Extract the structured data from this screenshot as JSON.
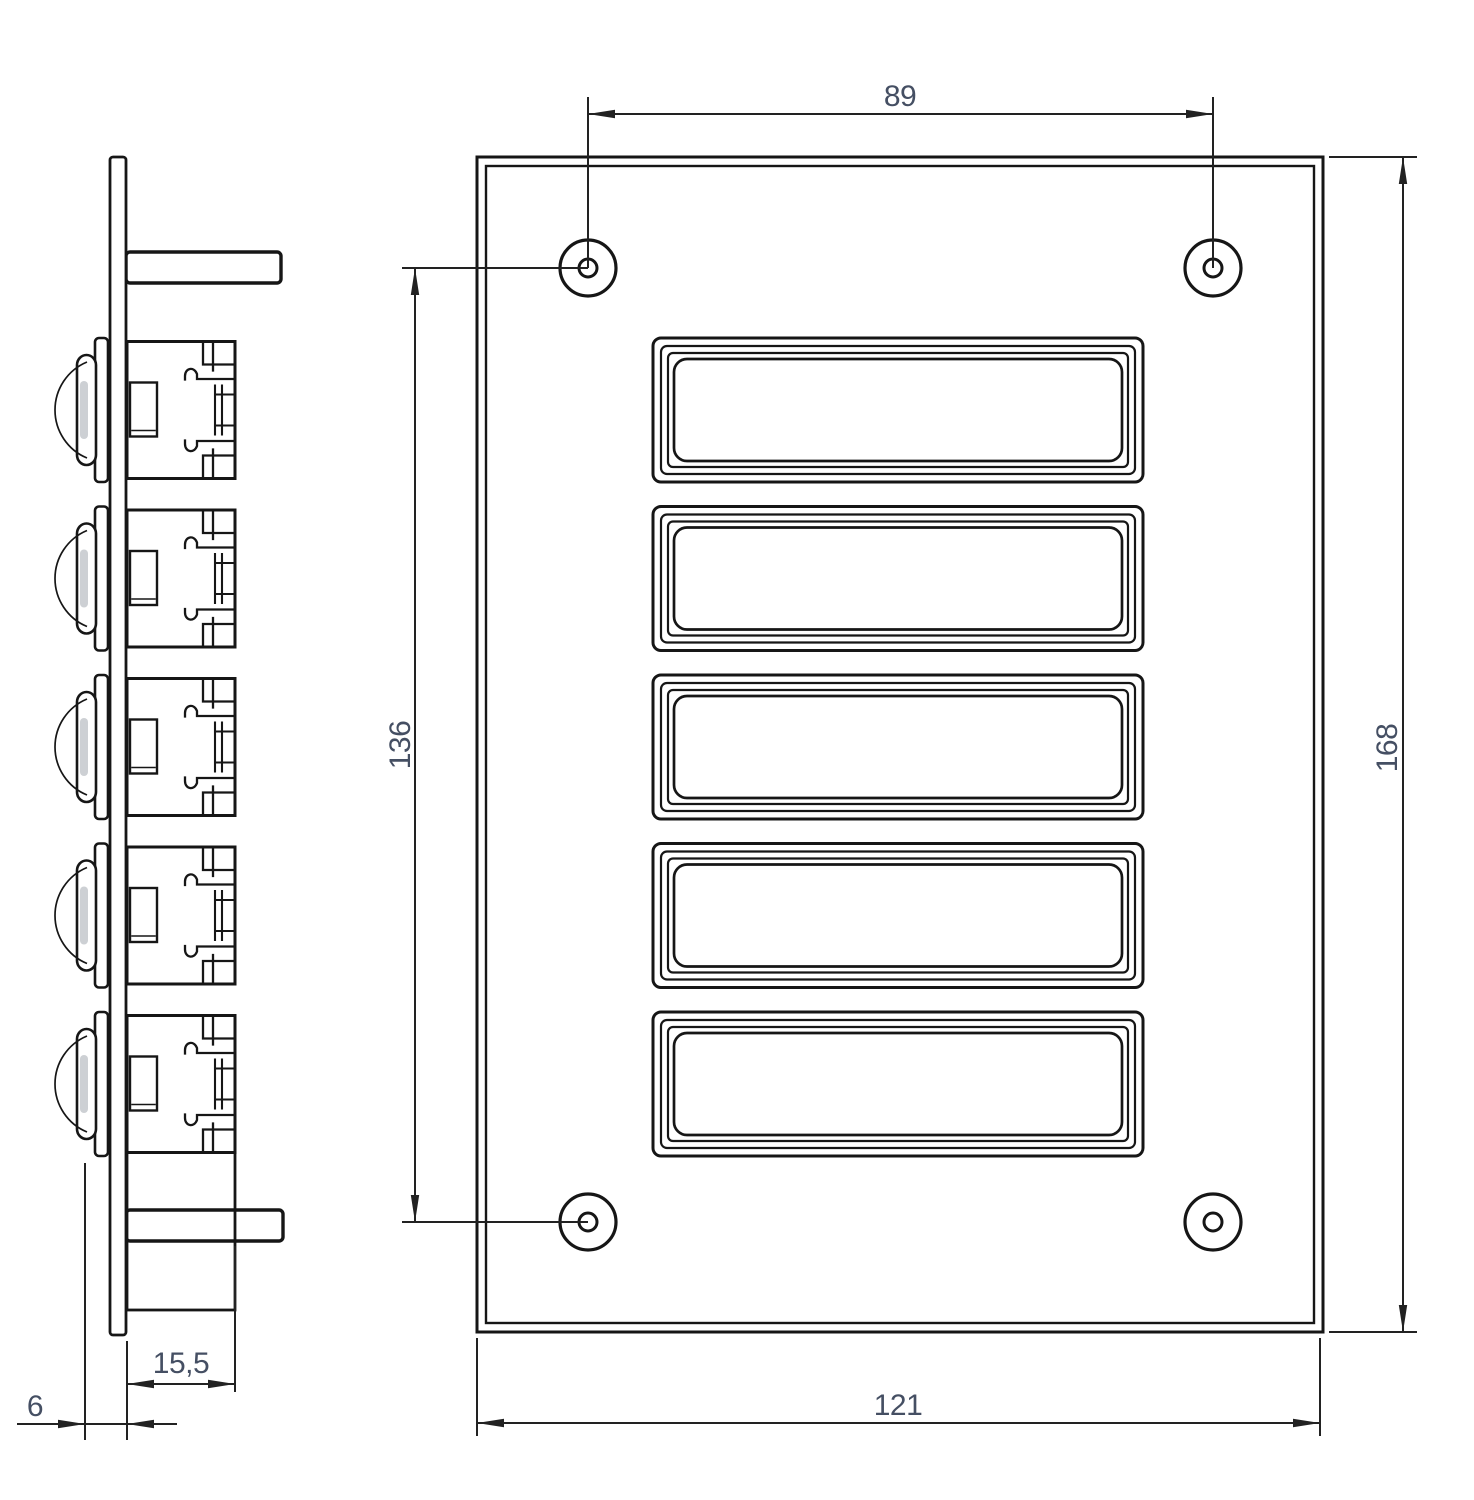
{
  "drawing": {
    "background": "#ffffff",
    "line_color": "#161616",
    "dimension_line_color": "#222222",
    "dimension_text_color": "#454f63",
    "side_view": {
      "push_button_count": 5,
      "bracket_count": 2
    },
    "front_view": {
      "name_plate_button_count": 5,
      "mounting_hole_count": 4
    },
    "dimensions": {
      "hole_spacing_horizontal": {
        "label": "89"
      },
      "hole_spacing_vertical": {
        "label": "136"
      },
      "plate_height": {
        "label": "168"
      },
      "plate_width": {
        "label": "121"
      },
      "unit_depth": {
        "label": "15,5"
      },
      "front_offset": {
        "label": "6"
      }
    }
  }
}
